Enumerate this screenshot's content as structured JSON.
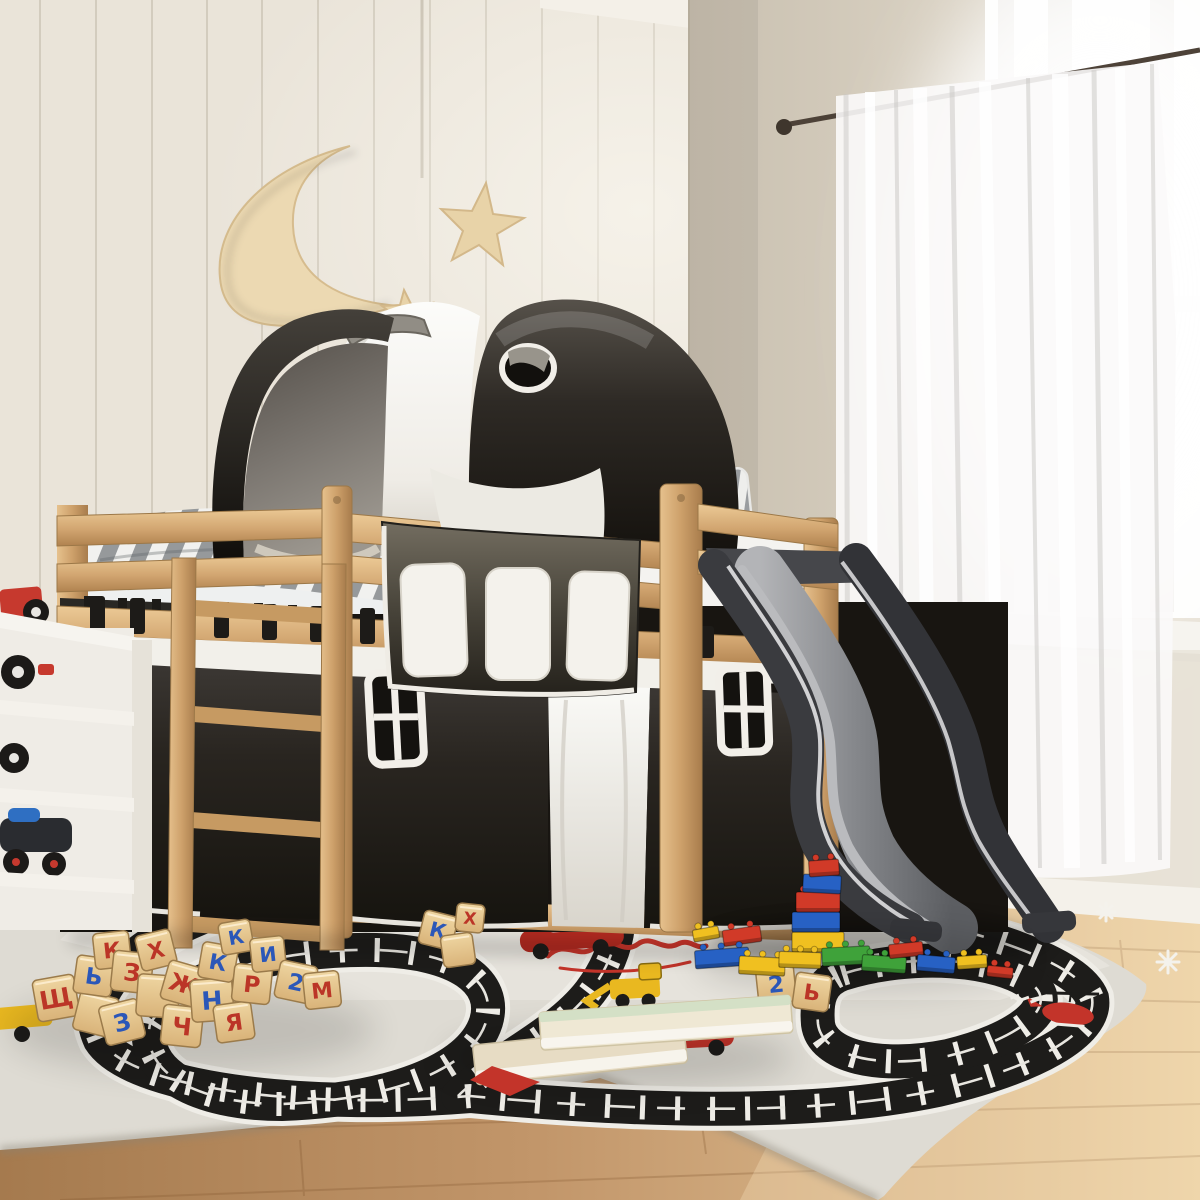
{
  "meta": {
    "type": "product-photo",
    "subject": "Children's room with a pine loft bed featuring a black and white play tunnel, under-bed curtains with windows, hanging pockets, an anthracite wavy slide, a race-track play rug, wooden letter blocks, toy bricks and books",
    "canvas": {
      "width": 1200,
      "height": 1200
    }
  },
  "palette": {
    "wall_left": "#eae4d9",
    "wall_right": "#d7cfc0",
    "wall_groove": "#d3ccbe",
    "window_glass": "#fdfdfc",
    "sheer_curtain": "#f8f7f6",
    "curtain_rod": "#4d4238",
    "pine_wood": "#d2a671",
    "pine_dark": "#a87c4c",
    "fabric_black": "#262320",
    "fabric_white": "#f2f0ea",
    "tunnel_grey_handle": "#918d85",
    "slide_dark": "#3a3b3f",
    "slide_surface": "#85878b",
    "floor_wood": "#c89a6b",
    "rug_base": "#dedbd3",
    "rug_track": "#1d1c1a",
    "rug_red": "#c3342a",
    "rug_yellow": "#e9b820",
    "moon_wood": "#ecd9b2",
    "mattress_stripe": "#96999b"
  },
  "objects": [
    {
      "name": "loft-bed",
      "desc": "natural pine loft bed with ladder and guard rails"
    },
    {
      "name": "play-tunnel",
      "desc": "black and white fabric tunnel with porthole on bed"
    },
    {
      "name": "wall-decor",
      "desc": "wooden crescent moon and two stars on beadboard wall"
    },
    {
      "name": "bed-curtains",
      "desc": "black under-bed curtains with white framed windows and white panel"
    },
    {
      "name": "hanging-pockets",
      "desc": "three white pockets on dark organizer panel"
    },
    {
      "name": "slide",
      "desc": "anthracite wavy slide from bed to rug"
    },
    {
      "name": "play-rug",
      "desc": "grey play rug with black race track, red script, cars, digger and helicopter"
    },
    {
      "name": "toy-shelf",
      "desc": "white shelf with toy vehicles"
    },
    {
      "name": "window",
      "desc": "bright window with white sheer curtains and dark rod"
    },
    {
      "name": "books",
      "desc": "two stacked books on rug"
    },
    {
      "name": "toy-bricks",
      "desc": "red, blue, yellow and green building bricks with a tower"
    },
    {
      "name": "letter-blocks",
      "desc": "wooden cubes with red and blue Cyrillic letters"
    }
  ],
  "blocks": {
    "letter_colors": {
      "red": "#bb3527",
      "blue": "#2b57b8"
    },
    "items": [
      {
        "x": 56,
        "y": 998,
        "s": 42,
        "r": -10,
        "ch": "Щ",
        "c": "red"
      },
      {
        "x": 96,
        "y": 1014,
        "s": 40,
        "r": 14,
        "ch": "",
        "c": ""
      },
      {
        "x": 94,
        "y": 976,
        "s": 38,
        "r": 8,
        "ch": "Ь",
        "c": "blue"
      },
      {
        "x": 112,
        "y": 950,
        "s": 36,
        "r": -6,
        "ch": "К",
        "c": "red"
      },
      {
        "x": 132,
        "y": 972,
        "s": 40,
        "r": 6,
        "ch": "З",
        "c": "red"
      },
      {
        "x": 122,
        "y": 1022,
        "s": 40,
        "r": -14,
        "ch": "З",
        "c": "blue"
      },
      {
        "x": 156,
        "y": 950,
        "s": 36,
        "r": -14,
        "ch": "Х",
        "c": "red"
      },
      {
        "x": 158,
        "y": 996,
        "s": 42,
        "r": 4,
        "ch": "",
        "c": ""
      },
      {
        "x": 182,
        "y": 1026,
        "s": 40,
        "r": 6,
        "ch": "Ч",
        "c": "red"
      },
      {
        "x": 184,
        "y": 984,
        "s": 40,
        "r": 16,
        "ch": "Ж",
        "c": "red"
      },
      {
        "x": 212,
        "y": 1000,
        "s": 42,
        "r": -4,
        "ch": "Н",
        "c": "blue"
      },
      {
        "x": 218,
        "y": 962,
        "s": 36,
        "r": 10,
        "ch": "К",
        "c": "blue"
      },
      {
        "x": 236,
        "y": 937,
        "s": 32,
        "r": -10,
        "ch": "К",
        "c": "blue"
      },
      {
        "x": 234,
        "y": 1022,
        "s": 38,
        "r": -8,
        "ch": "Я",
        "c": "red"
      },
      {
        "x": 252,
        "y": 984,
        "s": 38,
        "r": 6,
        "ch": "Р",
        "c": "red"
      },
      {
        "x": 268,
        "y": 954,
        "s": 34,
        "r": -6,
        "ch": "И",
        "c": "blue"
      },
      {
        "x": 296,
        "y": 982,
        "s": 38,
        "r": 12,
        "ch": "2",
        "c": "blue"
      },
      {
        "x": 322,
        "y": 990,
        "s": 36,
        "r": -6,
        "ch": "М",
        "c": "red"
      },
      {
        "x": 438,
        "y": 930,
        "s": 34,
        "r": 14,
        "ch": "К",
        "c": "blue"
      },
      {
        "x": 458,
        "y": 950,
        "s": 32,
        "r": -8,
        "ch": "",
        "c": ""
      },
      {
        "x": 470,
        "y": 918,
        "s": 28,
        "r": 6,
        "ch": "Х",
        "c": "red"
      },
      {
        "x": 776,
        "y": 984,
        "s": 38,
        "r": -6,
        "ch": "2",
        "c": "blue"
      },
      {
        "x": 812,
        "y": 992,
        "s": 36,
        "r": 8,
        "ch": "Ь",
        "c": "red"
      }
    ]
  },
  "lego": {
    "colors": {
      "R": "#d13a28",
      "B": "#2761c4",
      "Y": "#f0c020",
      "G": "#3fa23a"
    },
    "items": [
      {
        "x": 706,
        "y": 934,
        "w": 26,
        "h": 12,
        "c": "Y",
        "r": -10
      },
      {
        "x": 742,
        "y": 936,
        "w": 38,
        "h": 16,
        "c": "R",
        "r": -8
      },
      {
        "x": 818,
        "y": 942,
        "w": 52,
        "h": 20,
        "c": "Y",
        "r": 0
      },
      {
        "x": 816,
        "y": 922,
        "w": 48,
        "h": 20,
        "c": "B",
        "r": 0
      },
      {
        "x": 818,
        "y": 902,
        "w": 44,
        "h": 20,
        "c": "R",
        "r": 0
      },
      {
        "x": 822,
        "y": 884,
        "w": 38,
        "h": 18,
        "c": "B",
        "r": 3
      },
      {
        "x": 824,
        "y": 868,
        "w": 30,
        "h": 16,
        "c": "R",
        "r": -4
      },
      {
        "x": 722,
        "y": 958,
        "w": 54,
        "h": 18,
        "c": "B",
        "r": -4
      },
      {
        "x": 762,
        "y": 966,
        "w": 46,
        "h": 18,
        "c": "Y",
        "r": 3
      },
      {
        "x": 800,
        "y": 960,
        "w": 42,
        "h": 16,
        "c": "Y",
        "r": 2
      },
      {
        "x": 846,
        "y": 956,
        "w": 48,
        "h": 18,
        "c": "G",
        "r": -3
      },
      {
        "x": 884,
        "y": 964,
        "w": 44,
        "h": 16,
        "c": "G",
        "r": 4
      },
      {
        "x": 906,
        "y": 950,
        "w": 34,
        "h": 14,
        "c": "R",
        "r": -6
      },
      {
        "x": 936,
        "y": 964,
        "w": 38,
        "h": 16,
        "c": "B",
        "r": 5
      },
      {
        "x": 972,
        "y": 962,
        "w": 30,
        "h": 13,
        "c": "Y",
        "r": -4
      },
      {
        "x": 1000,
        "y": 972,
        "w": 26,
        "h": 11,
        "c": "R",
        "r": 6
      }
    ]
  }
}
